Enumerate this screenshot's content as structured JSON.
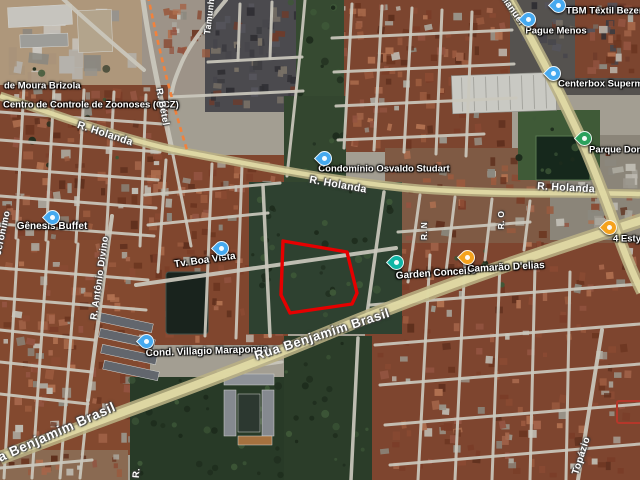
{
  "map": {
    "view": "satellite",
    "colors": {
      "parcel_outline": "#e60000",
      "parcel_secondary_outline": "#b5372a",
      "major_road_tint": "#b9b184",
      "major_road_core": "#e2dba6",
      "railway_orange": "#f2823c",
      "pin_blue": "#45a9ef",
      "pin_teal": "#10b5a5",
      "pin_orange": "#f5a21d",
      "pin_green": "#2ba15c"
    },
    "parcel_outline_points": [
      [
        283,
        241
      ],
      [
        347,
        252
      ],
      [
        357,
        293
      ],
      [
        352,
        304
      ],
      [
        290,
        313
      ],
      [
        281,
        295
      ]
    ],
    "parcel_secondary_rect": {
      "x": 617,
      "y": 401,
      "w": 26,
      "h": 22
    },
    "labels": [
      {
        "id": "moura-brizola",
        "text": "de Moura Brizola",
        "x": 4,
        "y": 86,
        "rot": 0,
        "size": 9.5,
        "anchor": "l",
        "kind": "poi"
      },
      {
        "id": "ccz",
        "text": "Centro de Controle de Zoonoses (CCZ)",
        "x": 3,
        "y": 105,
        "rot": 0,
        "size": 9.5,
        "anchor": "l",
        "kind": "poi"
      },
      {
        "id": "tbm-textil",
        "text": "TBM Têxtil Bezerra de",
        "x": 566,
        "y": 11,
        "rot": 0,
        "size": 9.5,
        "anchor": "l",
        "kind": "poi"
      },
      {
        "id": "pague-menos",
        "text": "Pague Menos",
        "x": 556,
        "y": 31,
        "rot": 0,
        "size": 9.5,
        "anchor": "c",
        "kind": "poi"
      },
      {
        "id": "centerbox",
        "text": "Centerbox Supermercado",
        "x": 558,
        "y": 84,
        "rot": 0,
        "size": 9.5,
        "anchor": "l",
        "kind": "poi"
      },
      {
        "id": "parque-dom",
        "text": "Parque Dom A",
        "x": 589,
        "y": 150,
        "rot": 0,
        "size": 9.5,
        "anchor": "l",
        "kind": "poi"
      },
      {
        "id": "condominio-osvaldo",
        "text": "Condomínio Osvaldo Studart",
        "x": 384,
        "y": 169,
        "rot": 0,
        "size": 9.5,
        "anchor": "c",
        "kind": "poi"
      },
      {
        "id": "tv-boa-vista",
        "text": "Tv. Boa Vista",
        "x": 205,
        "y": 261,
        "rot": -8,
        "size": 10,
        "anchor": "c",
        "kind": "poi"
      },
      {
        "id": "genesis-buffet",
        "text": "Gênesis Buffet",
        "x": 52,
        "y": 227,
        "rot": 0,
        "size": 10,
        "anchor": "c",
        "kind": "poi"
      },
      {
        "id": "cond-villagio",
        "text": "Cond. Villagio Maraponga",
        "x": 207,
        "y": 352,
        "rot": -2,
        "size": 10,
        "anchor": "c",
        "kind": "poi"
      },
      {
        "id": "garden-conceito",
        "text": "Garden Conceito",
        "x": 436,
        "y": 274,
        "rot": -4,
        "size": 10,
        "anchor": "c",
        "kind": "poi"
      },
      {
        "id": "camarao-delias",
        "text": "Camarão D'elias",
        "x": 506,
        "y": 268,
        "rot": -3,
        "size": 10,
        "anchor": "c",
        "kind": "poi"
      },
      {
        "id": "quatro-esty",
        "text": "4 Esty",
        "x": 613,
        "y": 239,
        "rot": 0,
        "size": 9.5,
        "anchor": "l",
        "kind": "poi"
      },
      {
        "id": "r-holanda-1",
        "text": "R. Holanda",
        "x": 105,
        "y": 134,
        "rot": 18,
        "size": 10.5,
        "anchor": "c",
        "kind": "road"
      },
      {
        "id": "r-holanda-2",
        "text": "R. Holanda",
        "x": 338,
        "y": 185,
        "rot": 10,
        "size": 10.5,
        "anchor": "c",
        "kind": "road"
      },
      {
        "id": "r-holanda-3",
        "text": "R. Holanda",
        "x": 566,
        "y": 188,
        "rot": 3,
        "size": 10.5,
        "anchor": "c",
        "kind": "road"
      },
      {
        "id": "rua-benjamim-1",
        "text": "Rua Benjamim Brasil",
        "x": 48,
        "y": 436,
        "rot": -24,
        "size": 13.5,
        "anchor": "c",
        "kind": "road big"
      },
      {
        "id": "rua-benjamim-2",
        "text": "Rua Benjamim Brasil",
        "x": 322,
        "y": 334,
        "rot": -18,
        "size": 13,
        "anchor": "c",
        "kind": "road big"
      },
      {
        "id": "r-betel",
        "text": "R. Bétel",
        "x": 162,
        "y": 107,
        "rot": 79,
        "size": 9.5,
        "anchor": "c",
        "kind": "road"
      },
      {
        "id": "tamunhe",
        "text": "Tamunhé",
        "x": 210,
        "y": 14,
        "rot": -83,
        "size": 9,
        "anchor": "c",
        "kind": "road"
      },
      {
        "id": "jeronimo",
        "text": "Jerônimo",
        "x": 3,
        "y": 233,
        "rot": -78,
        "size": 9.5,
        "anchor": "c",
        "kind": "road"
      },
      {
        "id": "r-antonio-divino",
        "text": "R. Antônio Divino",
        "x": 100,
        "y": 278,
        "rot": -82,
        "size": 9.5,
        "anchor": "c",
        "kind": "road"
      },
      {
        "id": "r-n",
        "text": "R. N",
        "x": 424,
        "y": 231,
        "rot": -90,
        "size": 8.5,
        "anchor": "c",
        "kind": "road"
      },
      {
        "id": "r-o",
        "text": "R. O",
        "x": 501,
        "y": 220,
        "rot": -90,
        "size": 8.5,
        "anchor": "c",
        "kind": "road"
      },
      {
        "id": "topazio",
        "text": "Topázio",
        "x": 582,
        "y": 456,
        "rot": -72,
        "size": 10,
        "anchor": "c",
        "kind": "road"
      },
      {
        "id": "r-cut",
        "text": "R.",
        "x": 137,
        "y": 473,
        "rot": -85,
        "size": 9.5,
        "anchor": "c",
        "kind": "road"
      },
      {
        "id": "manuel",
        "text": "Manuel",
        "x": 512,
        "y": 10,
        "rot": 55,
        "size": 9.5,
        "anchor": "c",
        "kind": "road"
      }
    ],
    "pins": [
      {
        "id": "tbm-textil",
        "x": 557,
        "y": 13,
        "color": "pin_blue"
      },
      {
        "id": "pague-menos",
        "x": 527,
        "y": 27,
        "color": "pin_blue"
      },
      {
        "id": "centerbox",
        "x": 552,
        "y": 81,
        "color": "pin_blue"
      },
      {
        "id": "parque-dom",
        "x": 583,
        "y": 146,
        "color": "pin_green"
      },
      {
        "id": "condominio-osvaldo",
        "x": 323,
        "y": 166,
        "color": "pin_blue"
      },
      {
        "id": "tv-boa-vista",
        "x": 220,
        "y": 256,
        "color": "pin_blue"
      },
      {
        "id": "genesis-buffet",
        "x": 51,
        "y": 225,
        "color": "pin_blue"
      },
      {
        "id": "cond-villagio",
        "x": 145,
        "y": 349,
        "color": "pin_blue"
      },
      {
        "id": "garden-conceito",
        "x": 395,
        "y": 270,
        "color": "pin_teal"
      },
      {
        "id": "camarao-delias",
        "x": 466,
        "y": 265,
        "color": "pin_orange"
      },
      {
        "id": "quatro-esty",
        "x": 608,
        "y": 235,
        "color": "pin_orange"
      }
    ]
  }
}
